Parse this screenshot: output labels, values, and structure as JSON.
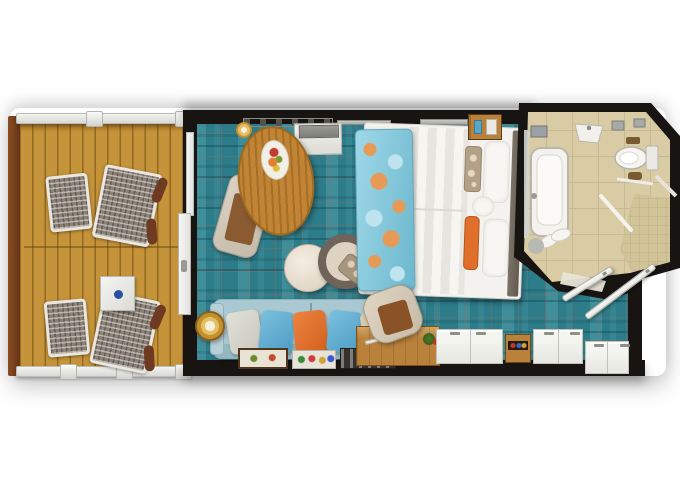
{
  "scene": {
    "type": "floor-plan",
    "title": "Balcony stateroom floor plan (top-down)",
    "background": "#ffffff",
    "text_visible": false
  },
  "colors": {
    "wall": "#171412",
    "deck_wood": "#c59339",
    "carpet": "#2d7c8a",
    "bathroom_floor": "#d9cba3",
    "bathroom_grout": "#c3b38b",
    "shower_tile": "#d2c499",
    "sofa": "#a9c8d1",
    "pillow_orange": "#e06f2c",
    "pillow_blue": "#5fb0d6",
    "lamp_gold": "#c2902c",
    "table_wood": "#c08434",
    "desk_wood": "#b9813a",
    "throw_teal": "#79c2d8",
    "throw_coral": "#e69a55",
    "fixture_white": "#f3f2ee"
  },
  "rooms": {
    "balcony": {
      "name": "Balcony",
      "furniture": [
        "lounge chair with footstool (upper)",
        "lounge chair with footstool (lower)",
        "side table with blue dot",
        "deck railing",
        "wood deck"
      ]
    },
    "living_bedroom": {
      "name": "Bedroom / Living Area",
      "furniture": [
        "double bed with teal-coral throw",
        "nightstand",
        "sofa with five cushions",
        "floor lamp",
        "round ottoman",
        "round swivel chair with pillow",
        "oval dining table with fruit plate",
        "dining chair",
        "vanity desk with TV",
        "desk chair",
        "wooden desk with plant",
        "wardrobe cabinets",
        "minibar shelf",
        "serving trays",
        "wall shelf",
        "wall clock",
        "sliding balcony door",
        "glass panel"
      ]
    },
    "bathroom": {
      "name": "Bathroom",
      "furniture": [
        "bathtub",
        "sink basin",
        "toilet",
        "shower with glass panel",
        "towel bar",
        "slippers and bath mat",
        "counter items",
        "mirror strip"
      ]
    },
    "entry": {
      "name": "Entry Vestibule",
      "furniture": [
        "bathroom door leaf",
        "entrance door leaf"
      ]
    }
  }
}
